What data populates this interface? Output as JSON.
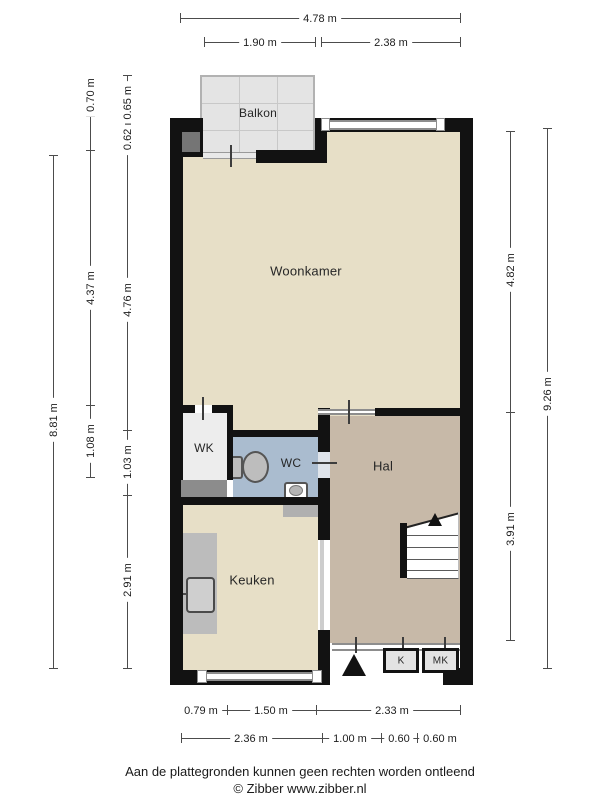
{
  "rooms": {
    "balkon": "Balkon",
    "woonkamer": "Woonkamer",
    "wk": "WK",
    "wc": "WC",
    "hal": "Hal",
    "keuken": "Keuken",
    "k": "K",
    "mk": "MK"
  },
  "dimensions": {
    "top_total": "4.78 m",
    "top_left": "1.90 m",
    "top_right": "2.38 m",
    "bottom_row1": [
      "0.79 m",
      "1.50 m",
      "2.33 m"
    ],
    "bottom_row2": [
      "2.36 m",
      "1.00 m",
      "0.60",
      "0.60 m"
    ],
    "left_outer": "8.81 m",
    "left_mid": [
      "0.70 m",
      "4.37 m",
      "1.08 m"
    ],
    "left_inner": [
      "0.62 ı 0.65 m",
      "4.76 m",
      "1.03 m",
      "2.91 m"
    ],
    "right_inner": [
      "4.82 m",
      "3.91 m"
    ],
    "right_outer": "9.26 m"
  },
  "footer": {
    "disclaimer": "Aan de plattegronden kunnen geen rechten worden ontleend",
    "credit": "© Zibber www.zibber.nl"
  },
  "colors": {
    "wall": "#121212",
    "living_floor": "#e7dfc7",
    "hall_floor": "#c7b9a8",
    "wc_floor": "#aabccf",
    "closet_floor": "#ededed",
    "balcony_floor": "#e4e4e4"
  }
}
